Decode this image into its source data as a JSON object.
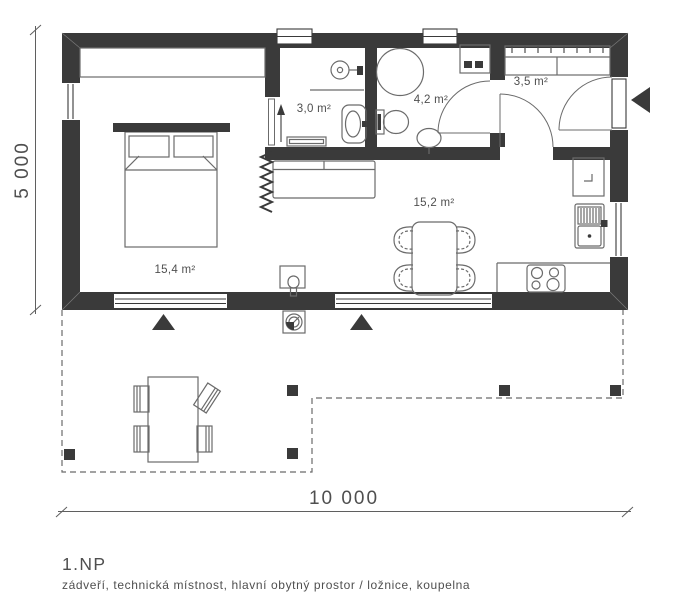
{
  "plan": {
    "floor_label": "1.NP",
    "rooms_caption": "zádveří, technická místnost, hlavní obytný prostor / ložnice, koupelna",
    "dim_width": "10 000",
    "dim_height": "5 000",
    "rooms": {
      "bedroom": {
        "area": "15,4 m²"
      },
      "technical": {
        "area": "3,0 m²"
      },
      "bathroom": {
        "area": "4,2 m²"
      },
      "hall": {
        "area": "3,5 m²"
      },
      "living": {
        "area": "15,2 m²"
      }
    }
  },
  "colors": {
    "wall": "#3a3a3a",
    "furniture": "#6b6b6b",
    "furniture_dark": "#4d4d4d",
    "text": "#4f4f4f",
    "dim": "#5f5f5f"
  }
}
